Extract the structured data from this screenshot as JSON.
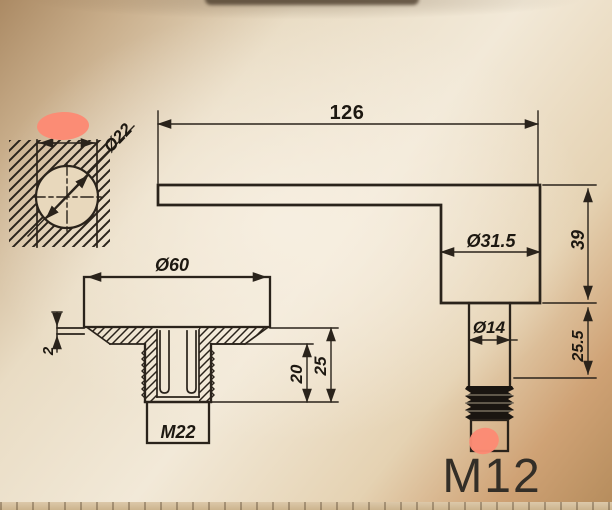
{
  "drawing": {
    "dimensions": {
      "arm_length": "126",
      "glass_hole_diameter": "Ø22",
      "cap_diameter": "Ø60",
      "body_diameter": "Ø31.5",
      "body_height": "39",
      "stud_diameter": "Ø14",
      "stud_length": "25.5",
      "gasket_thickness": "2",
      "sleeve_depth": "20",
      "sleeve_overall": "25",
      "sleeve_thread": "M22",
      "stud_thread": "M12"
    },
    "colors": {
      "line": "#2a231b",
      "highlight": "#fc8a74",
      "background_center": "#f2e9d8",
      "background_edge": "#ab8a64"
    }
  }
}
